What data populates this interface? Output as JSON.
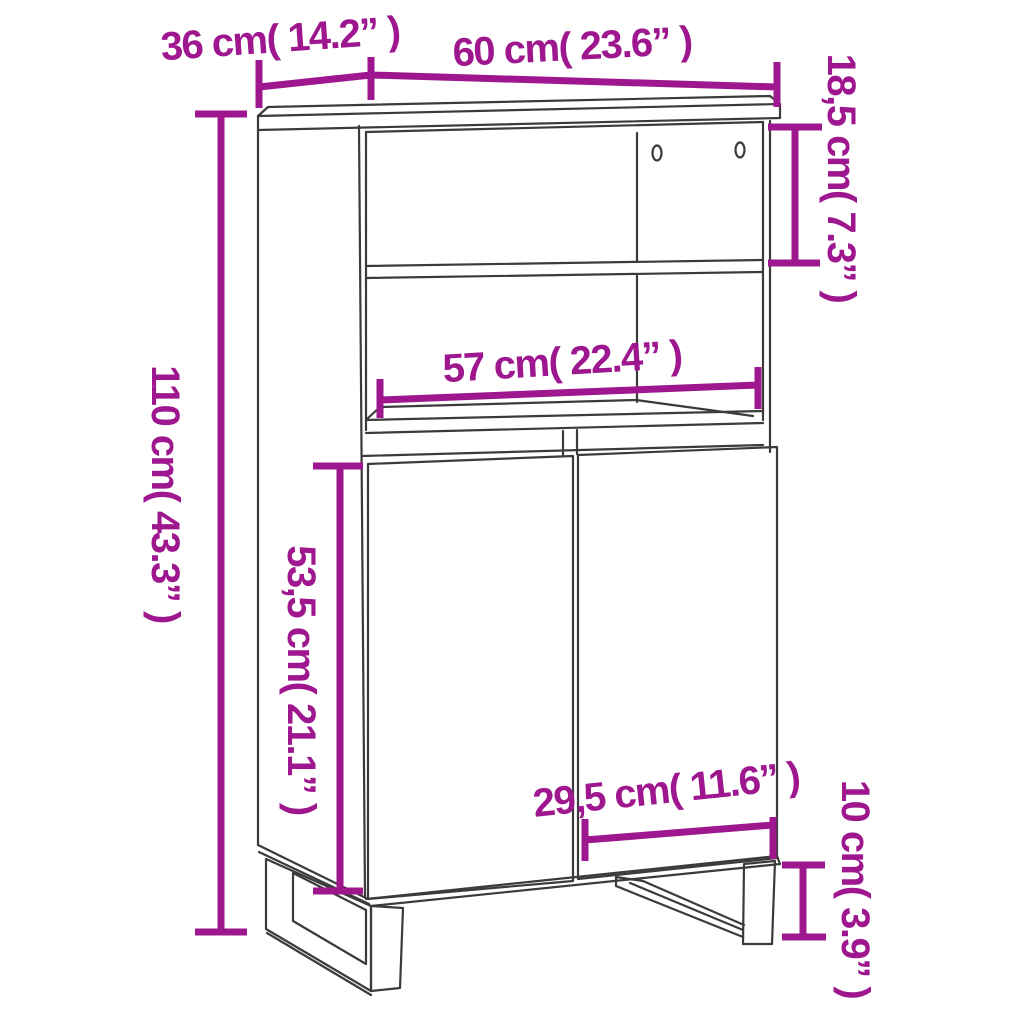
{
  "figure": {
    "kind": "furniture-dimension-diagram",
    "subject": "highboard cabinet with open shelves, two doors and sled-style legs",
    "background_color": "#ffffff",
    "line_color": "#3b3b3b",
    "dimension_color": "#9E178F"
  },
  "dimensions": {
    "depth": {
      "cm": "36",
      "inch": "14.2",
      "label": "36 cm( 14.2” )"
    },
    "width": {
      "cm": "60",
      "inch": "23.6",
      "label": "60 cm( 23.6” )"
    },
    "top_compartment_height": {
      "cm": "18,5",
      "inch": "7.3",
      "label": "18,5 cm( 7.3” )"
    },
    "total_height": {
      "cm": "110",
      "inch": "43.3",
      "label": "110 cm( 43.3” )"
    },
    "inner_width": {
      "cm": "57",
      "inch": "22.4",
      "label": "57 cm( 22.4” )"
    },
    "door_section_height": {
      "cm": "53,5",
      "inch": "21.1",
      "label": "53,5 cm( 21.1” )"
    },
    "door_width": {
      "cm": "29,5",
      "inch": "11.6",
      "label": "29,5 cm( 11.6” )"
    },
    "leg_height": {
      "cm": "10",
      "inch": "3.9",
      "label": "10 cm( 3.9” )"
    }
  }
}
